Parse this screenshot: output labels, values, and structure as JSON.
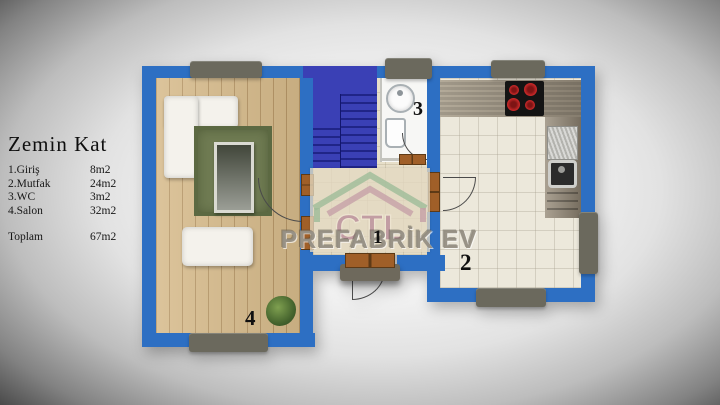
{
  "legend": {
    "title": "Zemin Kat",
    "rows": [
      {
        "label": "1.Giriş",
        "value": "8m2"
      },
      {
        "label": "2.Mutfak",
        "value": "24m2"
      },
      {
        "label": "3.WC",
        "value": "3m2"
      },
      {
        "label": "4.Salon",
        "value": "32m2"
      }
    ],
    "total": {
      "label": "Toplam",
      "value": "67m2"
    }
  },
  "floorplan": {
    "room_numbers": {
      "entrance": "1",
      "kitchen": "2",
      "wc": "3",
      "salon": "4"
    },
    "colors": {
      "wall": "#2d6fc3",
      "stairs": "#3a40b5",
      "wood_floor": "#d6ba8a",
      "rug": "#6f7b52",
      "kitchen_floor": "#ece8db",
      "hall_floor": "#e7dfc9",
      "window_block": "#6b695d",
      "door": "#9c5c26",
      "cooktop": "#141414",
      "burner": "#cf2b2b"
    }
  },
  "watermark": {
    "logo_text": "CTL",
    "brand_text": "PREFABRİK EV"
  }
}
